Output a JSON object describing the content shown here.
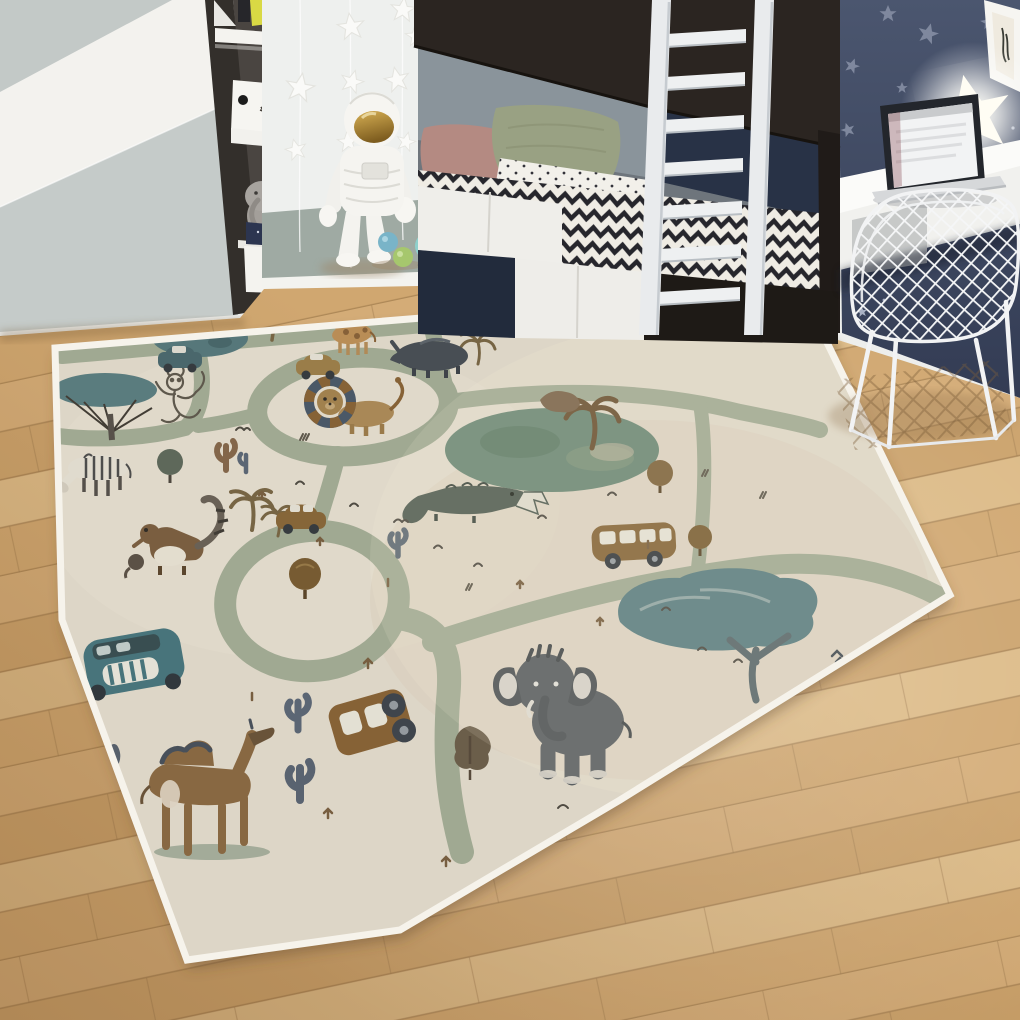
{
  "scene_title": "Children's bedroom with safari road play rug",
  "wall_art": {
    "script_text": "hello"
  },
  "palette": {
    "floor_wood": "#d2ab76",
    "rug_base": "#e9e1d2",
    "rug_road_sage": "#a6b098",
    "rug_border": "#f6f3eb",
    "navy_wall": "#46526c",
    "sage_wainscot": "#9faaa3",
    "wardrobe_grey": "#c3c9c7",
    "bed_wood_dark": "#2b2521",
    "ladder_white": "#e9ebed",
    "chevron_dark": "#26262c",
    "pillow_pink": "#b48a82",
    "pillow_sage": "#99a183",
    "visor_gold": "#c49a3e"
  },
  "objects": {
    "wardrobe": "two-tone grey and white wardrobe",
    "shelf_unit": "dark open shelf with boxes and plush elephant",
    "astronaut": "white astronaut figurine with gold visor",
    "star_garland": "hanging white star garlands",
    "bunk_bed": "dark wood bunk bed with chevron bedding",
    "ladder": "white bunk-bed ladder",
    "pillows": [
      "dusty pink",
      "sage green",
      "white polka dot sheet"
    ],
    "navy_wall": "navy wall with grey stars",
    "star_light": "glowing star night light",
    "poster": "white framed picture",
    "desk": "white wall-mounted desk",
    "laptop": "open silver laptop",
    "chair": "white wire-grid chair",
    "balls": [
      "blue",
      "green",
      "aqua"
    ],
    "rug": {
      "style": "beige safari road play rug",
      "animals": [
        "giraffe",
        "hippo",
        "rhino",
        "lion",
        "zebra",
        "monkey",
        "crocodile",
        "elephant",
        "camel",
        "meerkats"
      ],
      "vehicles": [
        "teal car",
        "tan car",
        "safari bus",
        "brown truck",
        "teal bus front"
      ],
      "plants": [
        "acacia trees",
        "palm trees",
        "cacti",
        "round bushes",
        "grass tufts"
      ]
    }
  }
}
